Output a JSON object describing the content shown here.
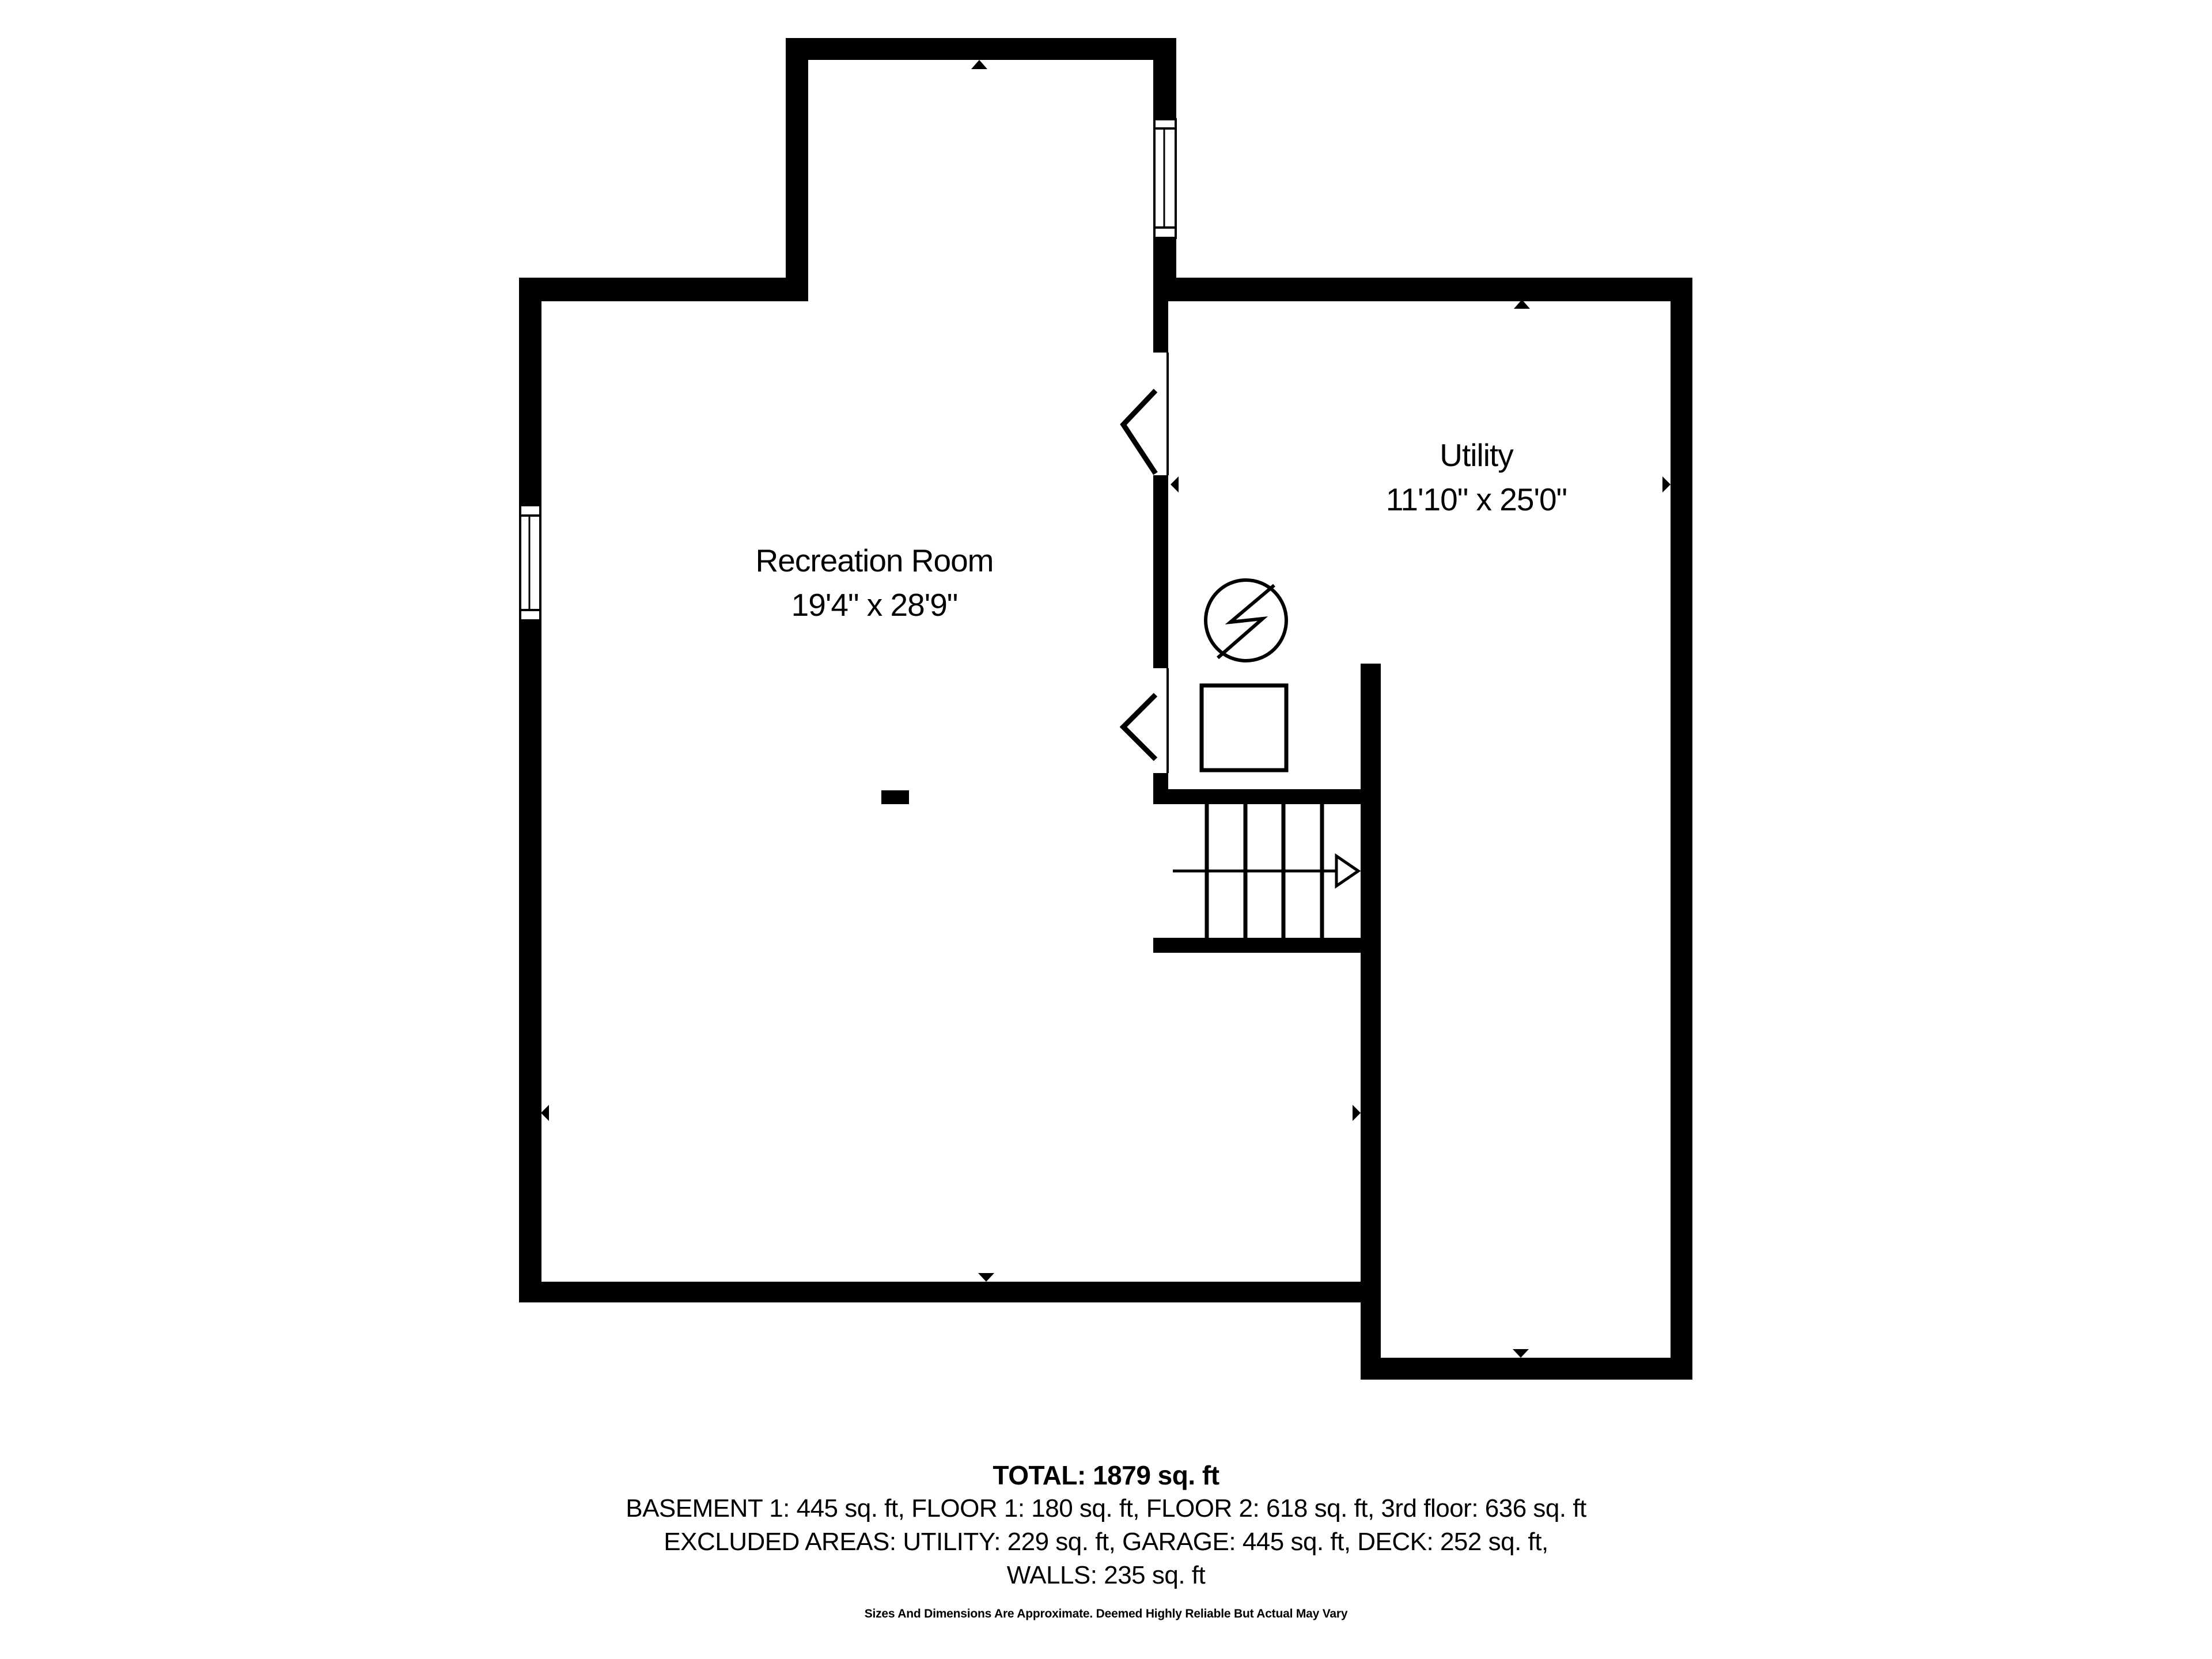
{
  "rooms": [
    {
      "name": "Recreation Room",
      "dimensions": "19'4\" x 28'9\""
    },
    {
      "name": "Utility",
      "dimensions": "11'10\" x 25'0\""
    }
  ],
  "summary": {
    "total": "TOTAL: 1879 sq. ft",
    "floors": "BASEMENT 1: 445 sq. ft, FLOOR 1: 180 sq. ft, FLOOR 2: 618 sq. ft, 3rd floor: 636 sq. ft",
    "excluded": "EXCLUDED AREAS: UTILITY: 229 sq. ft, GARAGE: 445 sq. ft, DECK: 252 sq. ft,",
    "walls": "WALLS: 235 sq. ft",
    "disclaimer": "Sizes And Dimensions Are Approximate. Deemed Highly Reliable But Actual May Vary"
  },
  "colors": {
    "wall": "#000000",
    "background": "#ffffff"
  },
  "icons": [
    "lightning-circle-icon",
    "equipment-square-icon",
    "stair-direction-arrow-icon",
    "window-icon",
    "door-swing-icon",
    "dimension-marker-icon"
  ]
}
